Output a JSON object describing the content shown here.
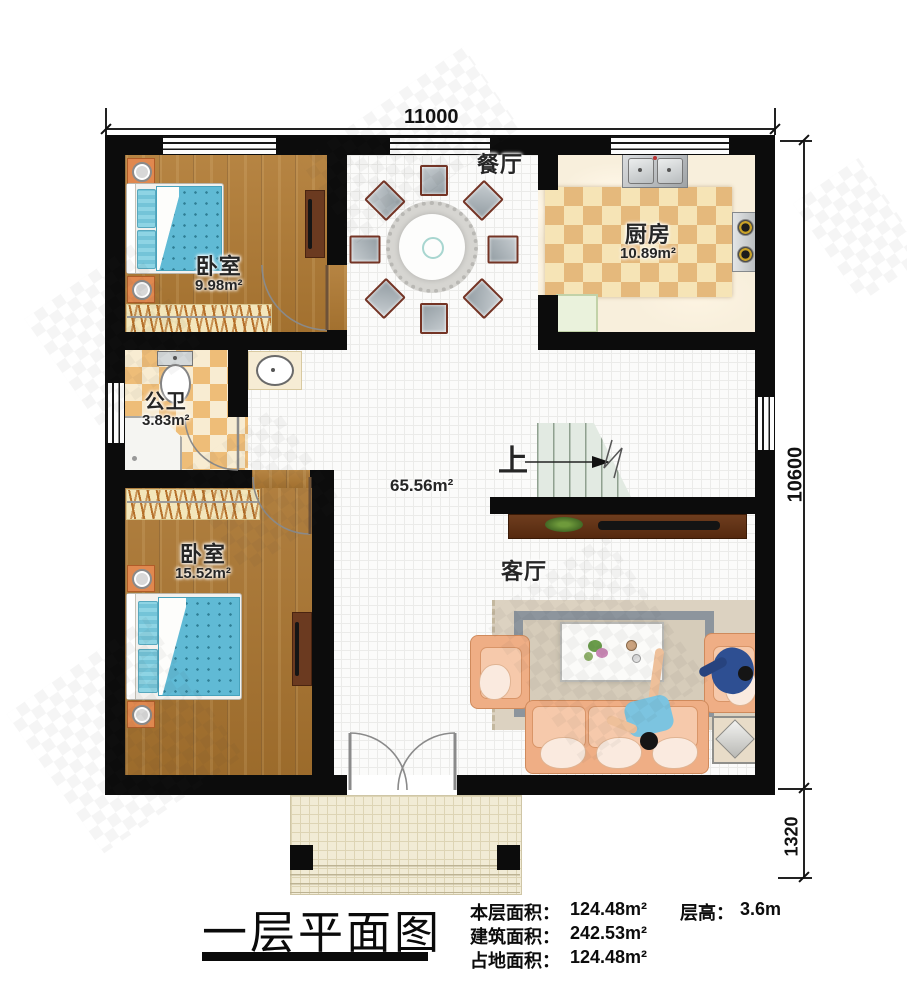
{
  "plan": {
    "dim_top": "11000",
    "dim_right": "10600",
    "dim_porch": "1320",
    "rooms": {
      "bedroom_top": {
        "name": "卧室",
        "area": "9.98m²"
      },
      "dining": {
        "name": "餐厅"
      },
      "kitchen": {
        "name": "厨房",
        "area": "10.89m²"
      },
      "bathroom": {
        "name": "公卫",
        "area": "3.83m²"
      },
      "bedroom_bottom": {
        "name": "卧室",
        "area": "15.52m²"
      },
      "living": {
        "name": "客厅"
      },
      "hall_area": "65.56m²",
      "stairs_up": "上"
    }
  },
  "footer": {
    "title": "一层平面图",
    "stats": [
      {
        "label": "本层面积：",
        "value": "124.48m²"
      },
      {
        "label": "建筑面积：",
        "value": "242.53m²"
      },
      {
        "label": "占地面积：",
        "value": "124.48m²"
      }
    ],
    "height_label": "层高：",
    "height_value": "3.6m"
  }
}
